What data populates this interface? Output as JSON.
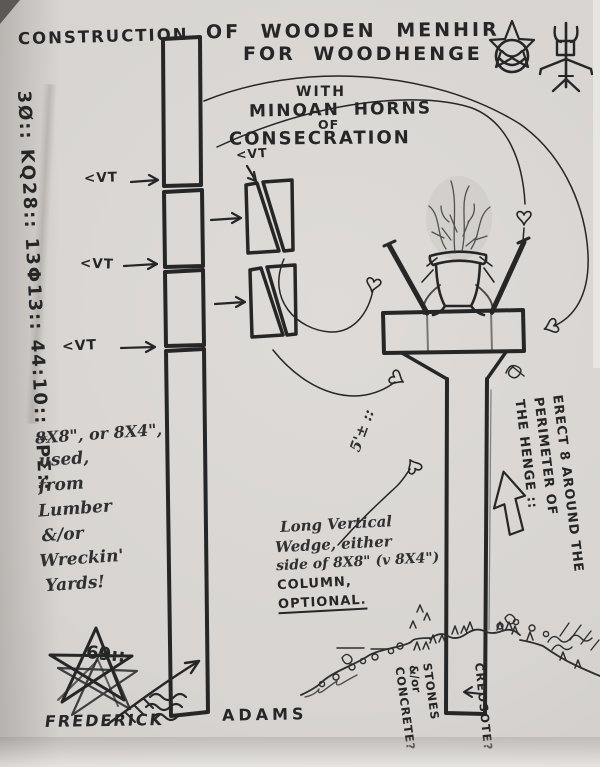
{
  "document": {
    "title_left": "CONSTRUCTION",
    "title_line1": "OF WOODEN MENHIR",
    "title_line2": "FOR WOODHENGE",
    "subtitle": {
      "with": "WITH",
      "line1": "MINOAN HORNS",
      "of": "OF",
      "line2": "CONSECRATION"
    }
  },
  "margin": {
    "left_cipher": "3Ø:: KQ28:: 13Φ13:: 44:10:: ♯PΣ::",
    "right_note": [
      "ERECT 8 AROUND THE",
      "PERIMETER OF",
      "THE HENGE ::"
    ]
  },
  "labels": {
    "vt1": "<VT",
    "vt2": "<VT",
    "vt3": "<VT",
    "vt_detail": "<VT",
    "height": "5'± ::",
    "creosote": "CREOSOTE?",
    "stones": [
      "STONES",
      "&/or",
      "CONCRETE?"
    ]
  },
  "notes": {
    "lumber": [
      "8X8\", or 8X4\",",
      "used,",
      "from",
      "Lumber",
      "&/or",
      "Wreckin'",
      "Yards!"
    ],
    "wedge": [
      "Long Vertical",
      "Wedge, either",
      "side of 8X8\" (v 8X4\")",
      "COLUMN,",
      "OPTIONAL."
    ]
  },
  "signature": {
    "monogram": "69::",
    "first": "FREDERICK",
    "last": "ADAMS"
  },
  "colors": {
    "ink": "#262626",
    "paper": "#d8d5d1"
  }
}
